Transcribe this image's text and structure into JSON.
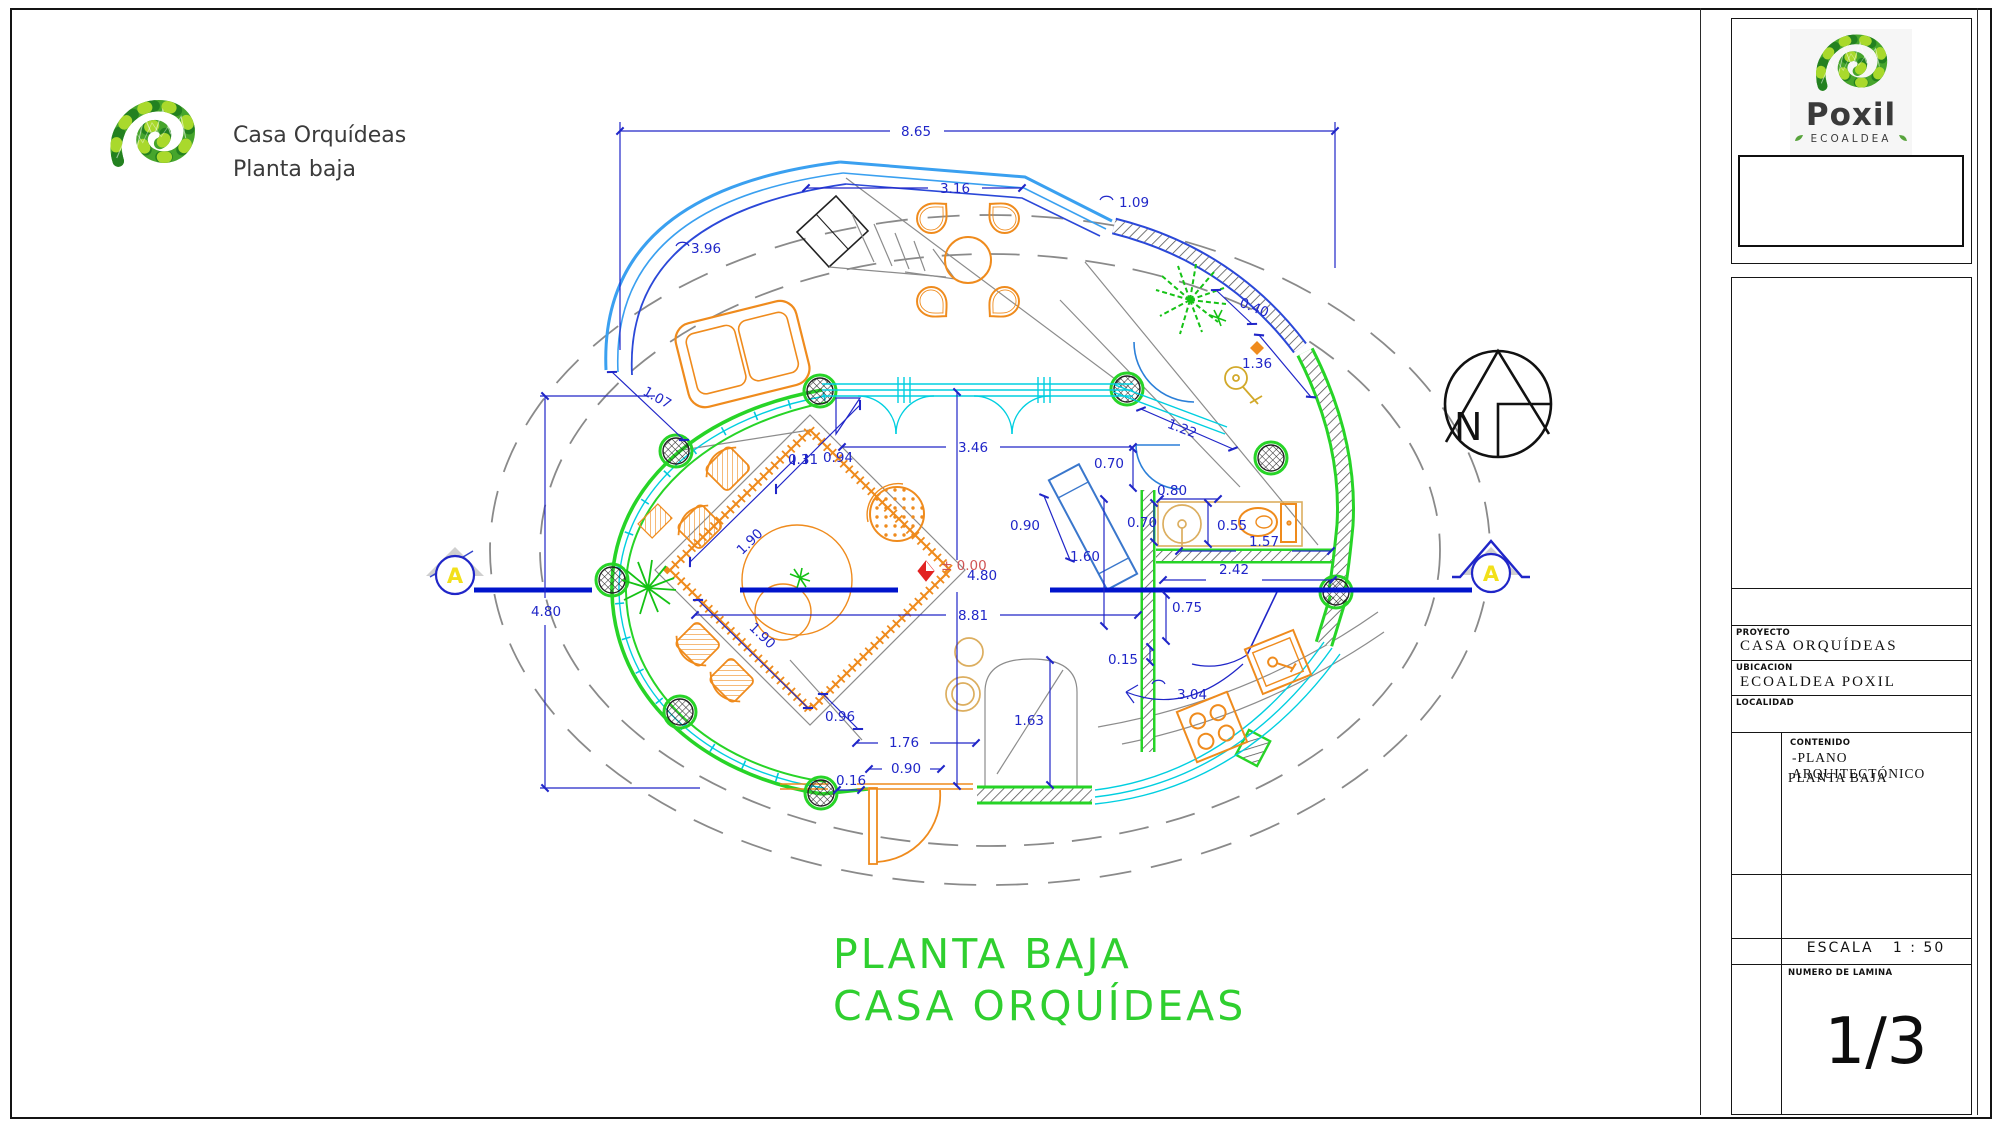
{
  "header": {
    "title": "Casa Orquídeas",
    "subtitle": "Planta baja"
  },
  "drawing_title": {
    "line1": "PLANTA BAJA",
    "line2": "CASA  ORQUÍDEAS"
  },
  "north_label": "N",
  "section_marker": "A",
  "level_marker": "± 0.00",
  "dimensions": {
    "top_overall": "8.65",
    "top_window": "3.16",
    "top_arc": "1.09",
    "left_arc": "3.96",
    "left_gap": "1.07",
    "left_height": "4.80",
    "interior_height": "4.80",
    "interior_width": "8.81",
    "door_top_a": "0.31",
    "door_top_b": "0.94",
    "window_main": "3.46",
    "bath_entry": "0.70",
    "terrace_seat": "0.40",
    "terrace_wall": "1.36",
    "terrace_win": "1.22",
    "bath_sink_w": "0.80",
    "bath_sink_d": "0.70",
    "bath_wc": "0.55",
    "bath_len": "1.57",
    "bath_h": "1.60",
    "bath_wall": "2.42",
    "bath_opening": "0.75",
    "wall_thickness": "0.15",
    "bench": "0.90",
    "rug_left": "1.90",
    "rug_bottom": "1.90",
    "entry_left": "0.96",
    "entry_width": "1.76",
    "door_bottom": "0.90",
    "step": "0.16",
    "entry_arch": "1.63",
    "pantry_arc": "3.04"
  },
  "brand": {
    "name": "Poxil",
    "subtitle": "ECOALDEA"
  },
  "titleblock": {
    "proyecto_label": "PROYECTO",
    "proyecto": "CASA  ORQUÍDEAS",
    "ubicacion_label": "UBICACION",
    "ubicacion": "ECOALDEA  POXIL",
    "localidad_label": "LOCALIDAD",
    "localidad": "",
    "contenido_label": "CONTENIDO",
    "contenido_line1": "-PLANO  ARQUITECTÓNICO",
    "contenido_line2": "PLANTA  BAJA",
    "escala_label": "ESCALA",
    "escala_value": "1  :  50",
    "lamina_label": "NUMERO  DE  LAMINA",
    "lamina_value": "1/3"
  },
  "colors": {
    "dimension_blue": "#2026c8",
    "wall_green": "#27d427",
    "glass_cyan": "#00cfe0",
    "curtain_blue": "#3aa0f0",
    "furniture_orange": "#ef8b1d",
    "title_green": "#2fcf2f",
    "section_blue": "#0014cc",
    "level_red": "#e22222"
  }
}
